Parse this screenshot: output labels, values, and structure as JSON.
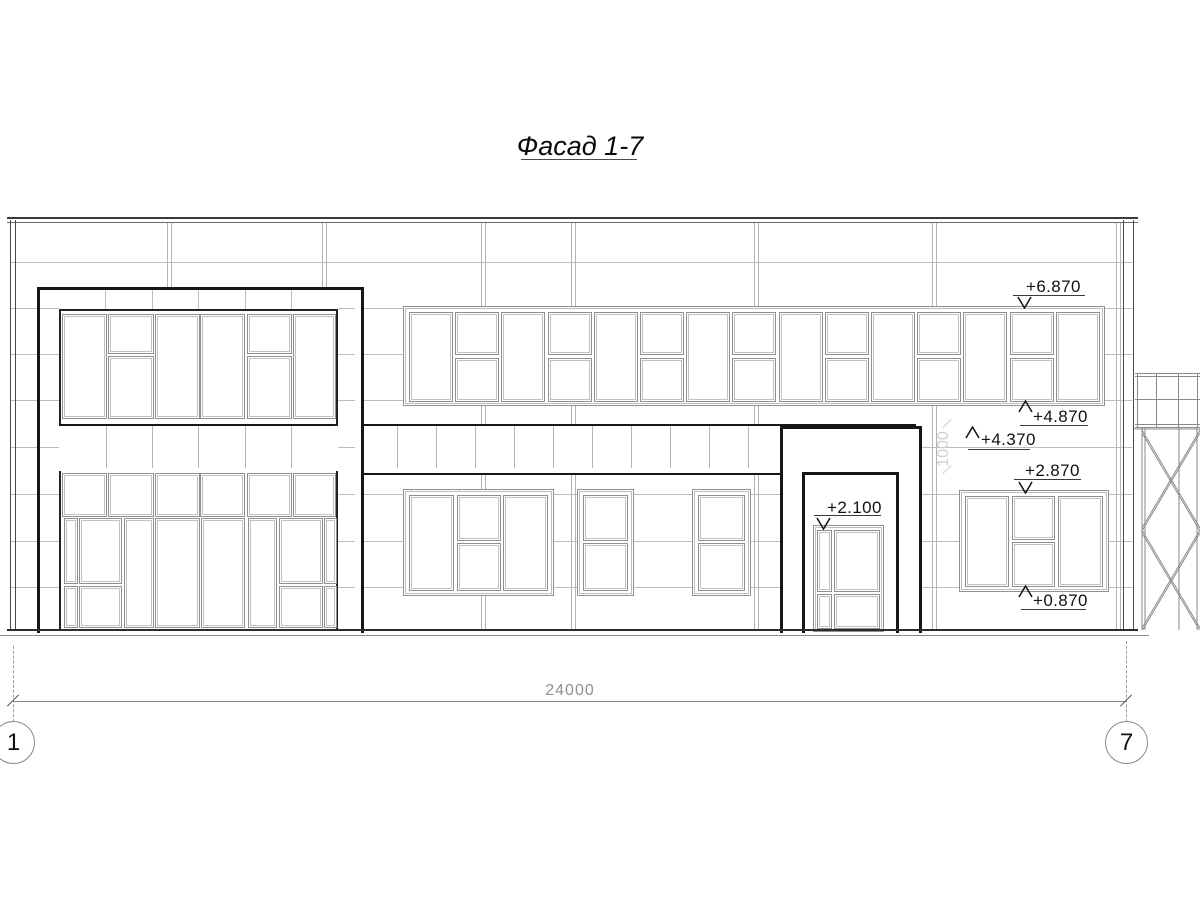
{
  "title": "Фасад 1-7",
  "elevation_marks": [
    {
      "label": "+6.870",
      "direction": "down"
    },
    {
      "label": "+4.870",
      "direction": "up"
    },
    {
      "label": "+4.370",
      "direction": "up"
    },
    {
      "label": "+2.870",
      "direction": "down"
    },
    {
      "label": "+2.100",
      "direction": "down"
    },
    {
      "label": "+0.870",
      "direction": "up"
    }
  ],
  "dimensions": {
    "overall_width": "24000",
    "band_height": "1000"
  },
  "axis_bubbles": [
    {
      "label": "1"
    },
    {
      "label": "7"
    }
  ],
  "colors": {
    "line_dark": "#161616",
    "line_medium": "#8a8a8a",
    "line_light": "#b4b4b4",
    "dim_gray": "#909090",
    "background": "#ffffff"
  }
}
